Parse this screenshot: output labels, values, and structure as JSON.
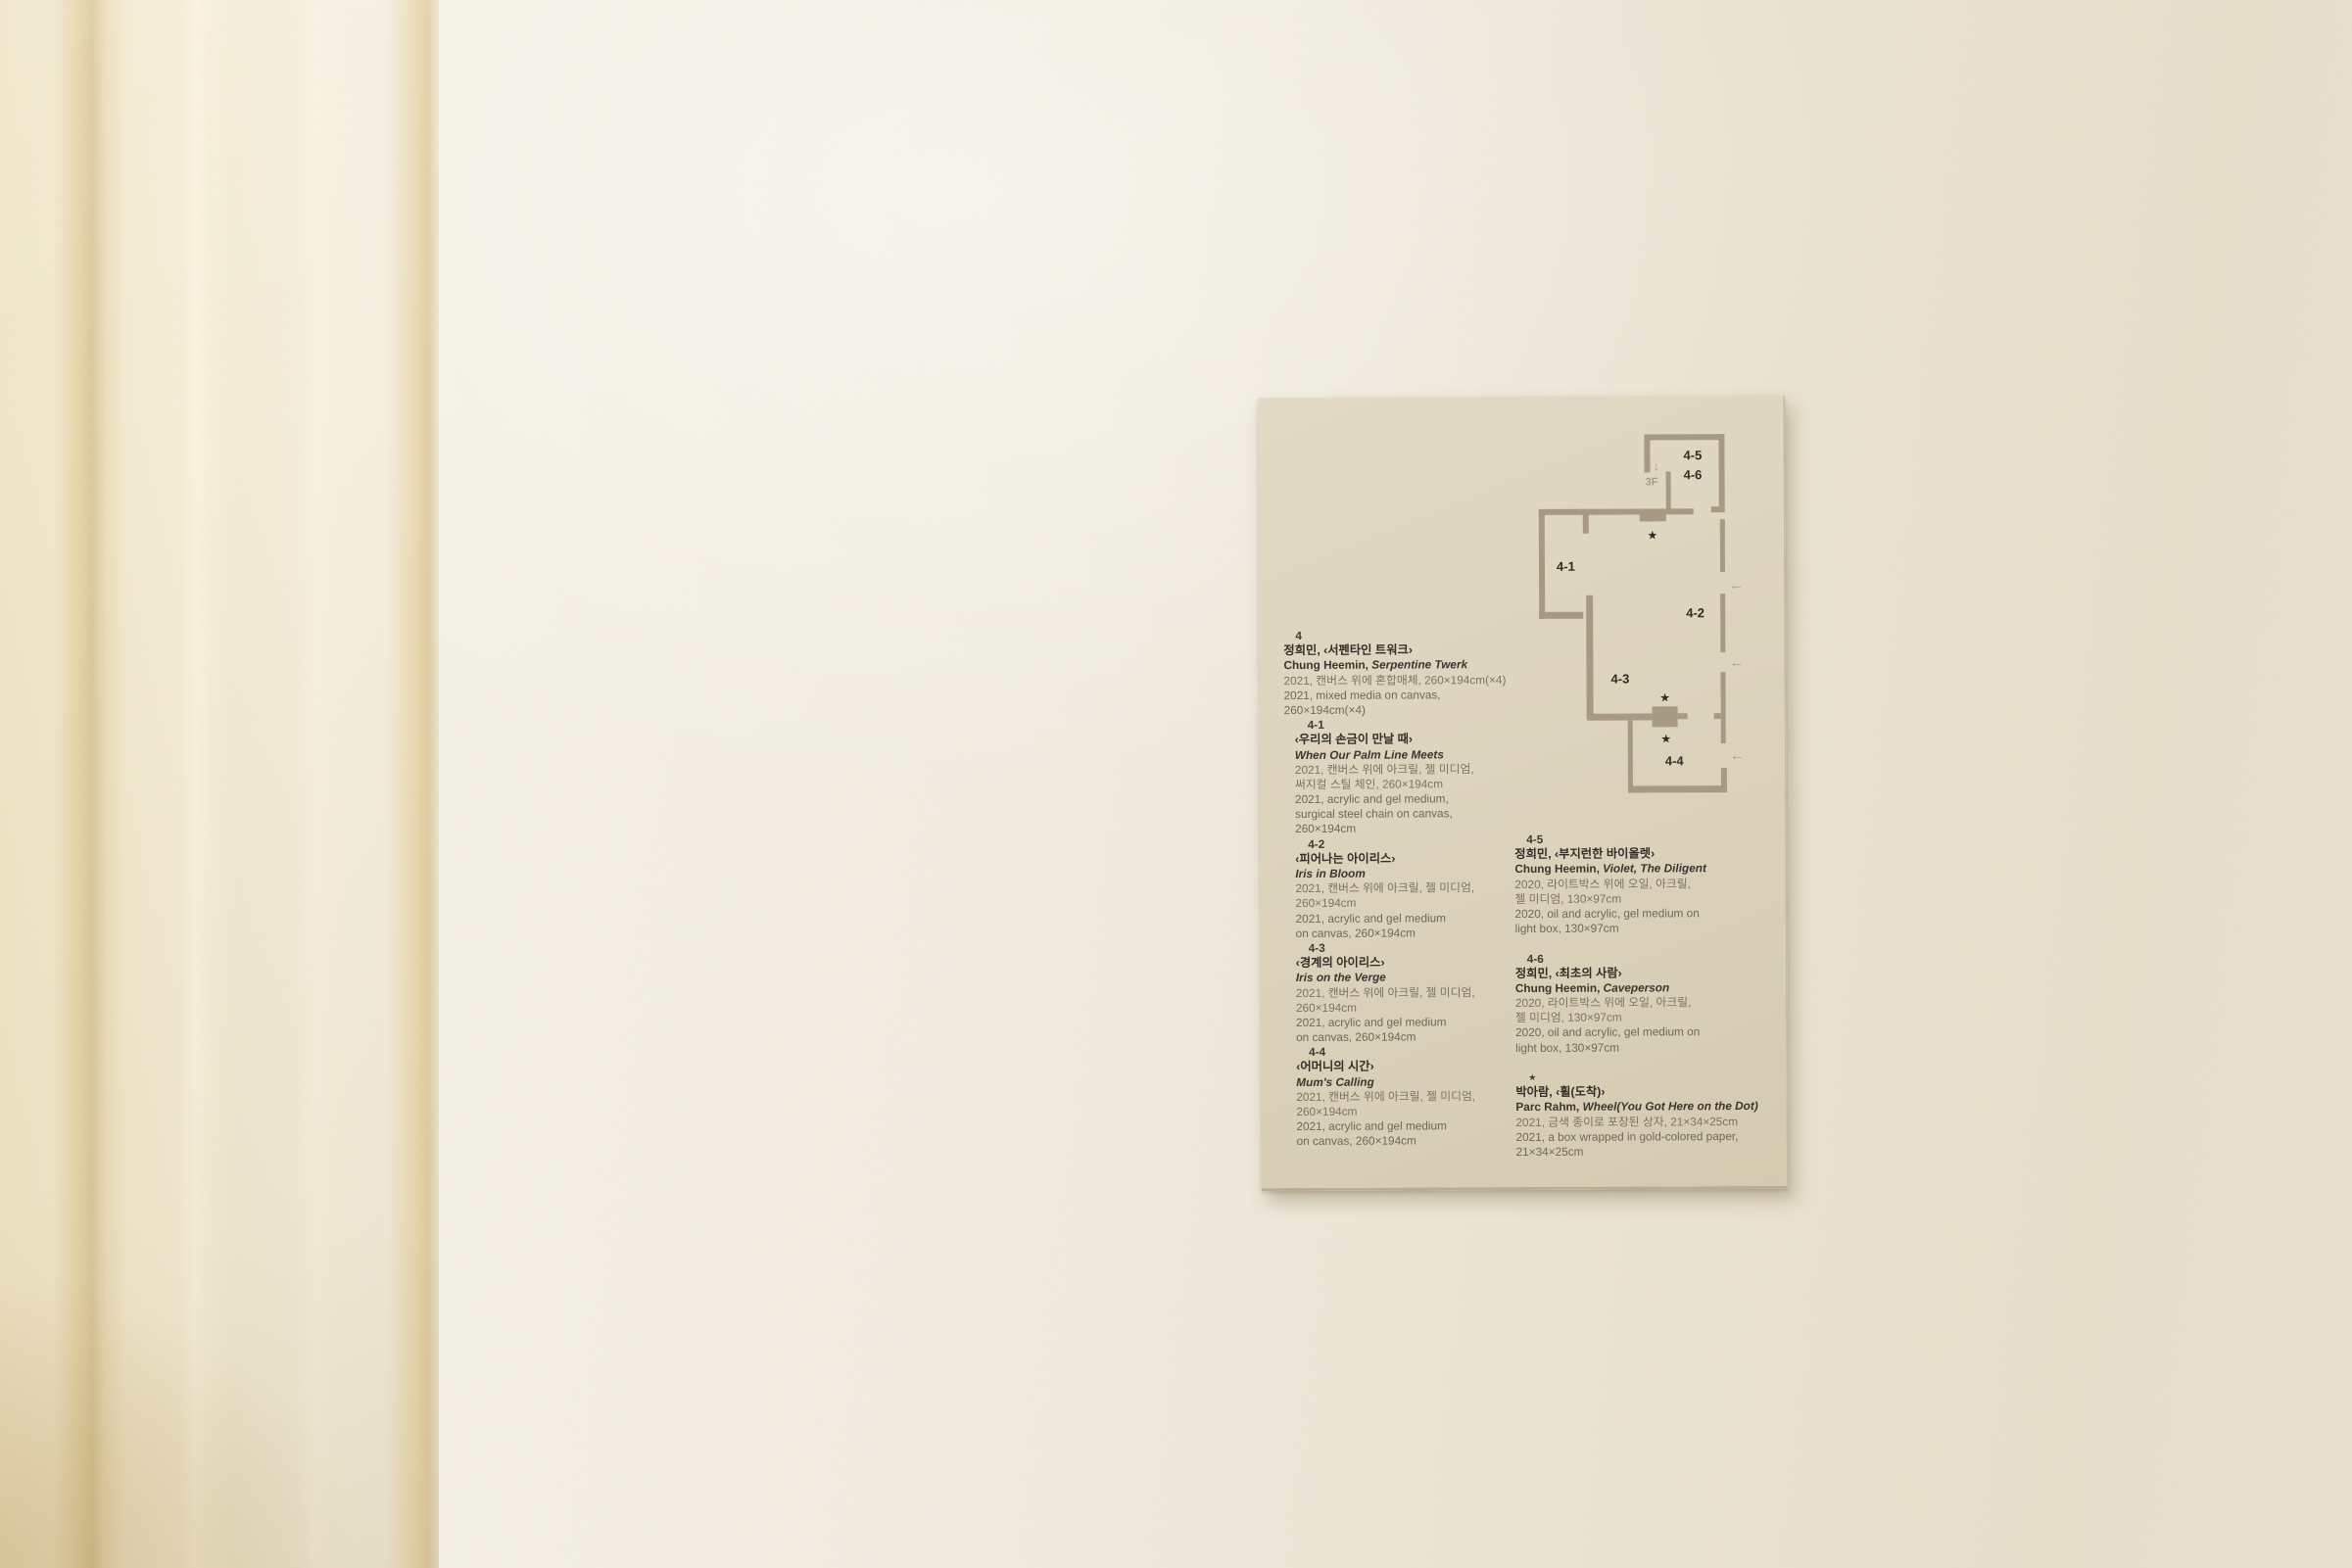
{
  "palette": {
    "wall": "#efe9da",
    "molding": "#f4ebd1",
    "card": "#dcd2bc",
    "plan_wall": "#a89a82",
    "plan_label": "#2f2b24",
    "title_text": "#332f28",
    "caption_text": "#70665a"
  },
  "plan": {
    "stair": {
      "arrow": "↓",
      "label": "3F"
    },
    "entry_arrow": "←",
    "star": "★",
    "rooms": [
      {
        "id": "4-5"
      },
      {
        "id": "4-6"
      },
      {
        "id": "4-1"
      },
      {
        "id": "4-2"
      },
      {
        "id": "4-3"
      },
      {
        "id": "4-4"
      }
    ]
  },
  "columns": {
    "left": [
      {
        "k": "num",
        "t": "4"
      },
      {
        "k": "kr-t",
        "t": "정희민, ‹서펜타인 트워크›"
      },
      {
        "k": "en-t",
        "pre": "Chung Heemin, ",
        "it": "Serpentine Twerk"
      },
      {
        "k": "kr-d",
        "t": "2021, 캔버스 위에 혼합매체, 260×194cm(×4)"
      },
      {
        "k": "en-d",
        "t": "2021, mixed media on canvas,"
      },
      {
        "k": "en-d",
        "t": "260×194cm(×4)"
      },
      {
        "k": "num2",
        "t": "4-1"
      },
      {
        "k": "kr-t",
        "sub": 1,
        "t": "‹우리의 손금이 만날 때›"
      },
      {
        "k": "en-t",
        "sub": 1,
        "it": "When Our Palm Line Meets"
      },
      {
        "k": "kr-d",
        "sub": 1,
        "t": "2021, 캔버스 위에 아크릴, 젤 미디엄,"
      },
      {
        "k": "kr-d",
        "sub": 1,
        "t": "써지컬 스틸 체인, 260×194cm"
      },
      {
        "k": "en-d",
        "sub": 1,
        "t": "2021, acrylic and gel medium,"
      },
      {
        "k": "en-d",
        "sub": 1,
        "t": "surgical steel chain on canvas,"
      },
      {
        "k": "en-d",
        "sub": 1,
        "t": "260×194cm"
      },
      {
        "k": "num2",
        "t": "4-2"
      },
      {
        "k": "kr-t",
        "sub": 1,
        "t": "‹피어나는 아이리스›"
      },
      {
        "k": "en-t",
        "sub": 1,
        "it": "Iris in Bloom"
      },
      {
        "k": "kr-d",
        "sub": 1,
        "t": "2021, 캔버스 위에 아크릴, 젤 미디엄,"
      },
      {
        "k": "kr-d",
        "sub": 1,
        "t": "260×194cm"
      },
      {
        "k": "en-d",
        "sub": 1,
        "t": "2021, acrylic and gel medium"
      },
      {
        "k": "en-d",
        "sub": 1,
        "t": "on canvas, 260×194cm"
      },
      {
        "k": "num2",
        "t": "4-3"
      },
      {
        "k": "kr-t",
        "sub": 1,
        "t": "‹경계의 아이리스›"
      },
      {
        "k": "en-t",
        "sub": 1,
        "it": "Iris on the Verge"
      },
      {
        "k": "kr-d",
        "sub": 1,
        "t": "2021, 캔버스 위에 아크릴, 젤 미디엄,"
      },
      {
        "k": "kr-d",
        "sub": 1,
        "t": "260×194cm"
      },
      {
        "k": "en-d",
        "sub": 1,
        "t": "2021, acrylic and gel medium"
      },
      {
        "k": "en-d",
        "sub": 1,
        "t": "on canvas, 260×194cm"
      },
      {
        "k": "num2",
        "t": "4-4"
      },
      {
        "k": "kr-t",
        "sub": 1,
        "t": "‹어머니의 시간›"
      },
      {
        "k": "en-t",
        "sub": 1,
        "it": "Mum's Calling"
      },
      {
        "k": "kr-d",
        "sub": 1,
        "t": "2021, 캔버스 위에 아크릴, 젤 미디엄,"
      },
      {
        "k": "kr-d",
        "sub": 1,
        "t": "260×194cm"
      },
      {
        "k": "en-d",
        "sub": 1,
        "t": "2021, acrylic and gel medium"
      },
      {
        "k": "en-d",
        "sub": 1,
        "t": "on canvas, 260×194cm"
      }
    ],
    "right": [
      {
        "k": "num",
        "t": "4-5"
      },
      {
        "k": "kr-t",
        "t": "정희민, ‹부지런한 바이올렛›"
      },
      {
        "k": "en-t",
        "pre": "Chung Heemin, ",
        "it": "Violet, The Diligent"
      },
      {
        "k": "kr-d",
        "t": "2020, 라이트박스 위에 오일, 아크릴,"
      },
      {
        "k": "kr-d",
        "t": "젤 미디엄, 130×97cm"
      },
      {
        "k": "en-d",
        "t": "2020, oil and acrylic, gel medium on"
      },
      {
        "k": "en-d",
        "t": "light box, 130×97cm"
      },
      {
        "k": "blank"
      },
      {
        "k": "num",
        "t": "4-6"
      },
      {
        "k": "kr-t",
        "t": "정희민, ‹최초의 사람›"
      },
      {
        "k": "en-t",
        "pre": "Chung Heemin, ",
        "it": "Caveperson"
      },
      {
        "k": "kr-d",
        "t": "2020, 라이트박스 위에 오일, 아크릴,"
      },
      {
        "k": "kr-d",
        "t": "젤 미디엄, 130×97cm"
      },
      {
        "k": "en-d",
        "t": "2020, oil and acrylic, gel medium on"
      },
      {
        "k": "en-d",
        "t": "light box, 130×97cm"
      },
      {
        "k": "blank"
      },
      {
        "k": "star",
        "t": "★"
      },
      {
        "k": "kr-t",
        "t": "박아람, ‹휠(도착)›"
      },
      {
        "k": "en-t",
        "pre": "Parc Rahm, ",
        "it": "Wheel(You Got Here on the Dot)"
      },
      {
        "k": "kr-d",
        "t": "2021, 금색 종이로 포장된 상자, 21×34×25cm"
      },
      {
        "k": "en-d",
        "t": "2021, a box wrapped in gold-colored paper,"
      },
      {
        "k": "en-d",
        "t": "21×34×25cm"
      }
    ]
  }
}
